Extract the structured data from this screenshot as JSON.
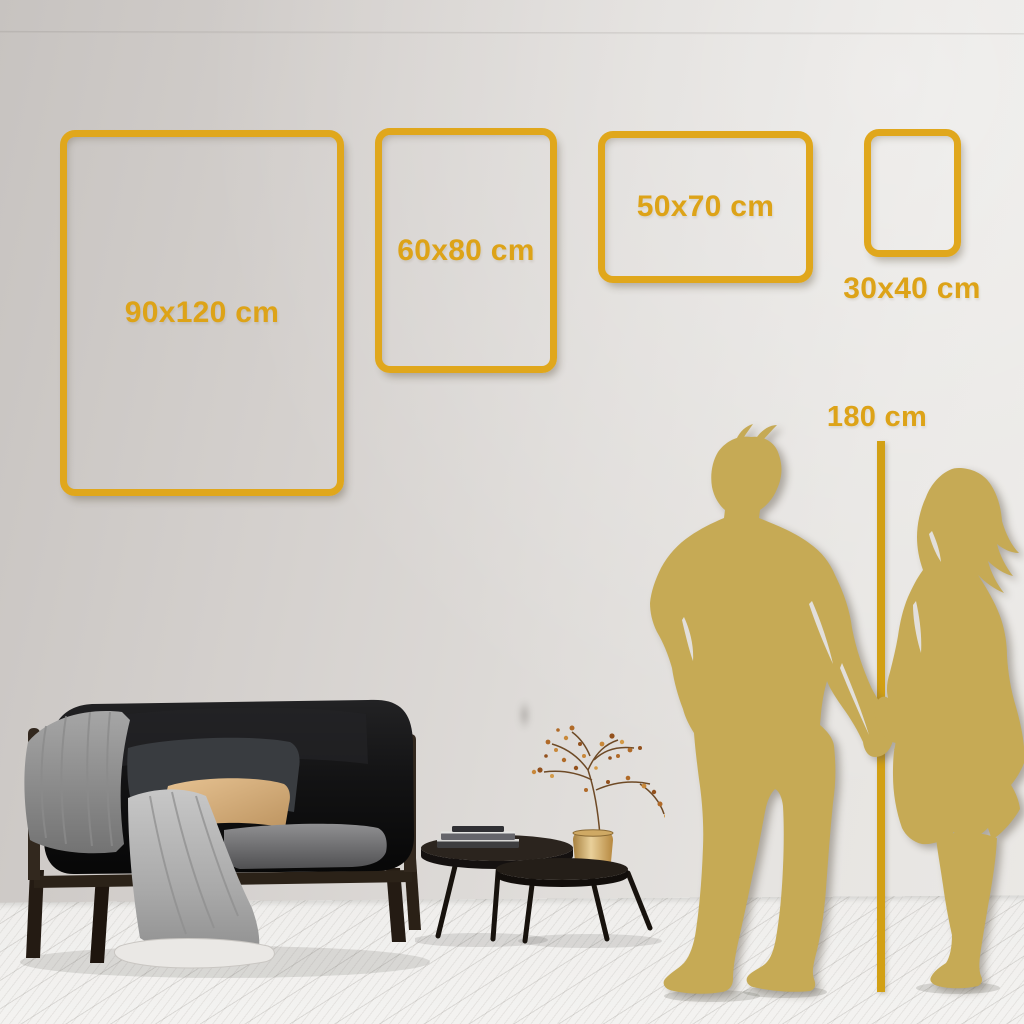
{
  "scene_title": "Poster size comparison in living room",
  "accent_colors": {
    "frame_gold": "#E0A71C",
    "label_gold": "#DDA318",
    "silhouette_gold": "#C6AA55",
    "marker_line_gold": "#D2A014"
  },
  "size_frames": {
    "items": [
      {
        "label": "90x120 cm",
        "orientation": "portrait"
      },
      {
        "label": "60x80 cm",
        "orientation": "portrait"
      },
      {
        "label": "50x70 cm",
        "orientation": "landscape"
      },
      {
        "label": "30x40 cm",
        "orientation": "portrait"
      }
    ]
  },
  "height_marker": {
    "label": "180 cm"
  },
  "scene_objects": {
    "items": [
      "sofa-with-throw-blanket",
      "pillows",
      "nesting-coffee-tables",
      "books-stack",
      "brass-vase-dried-branch",
      "man-silhouette",
      "woman-silhouette",
      "wood-plank-floor"
    ]
  }
}
